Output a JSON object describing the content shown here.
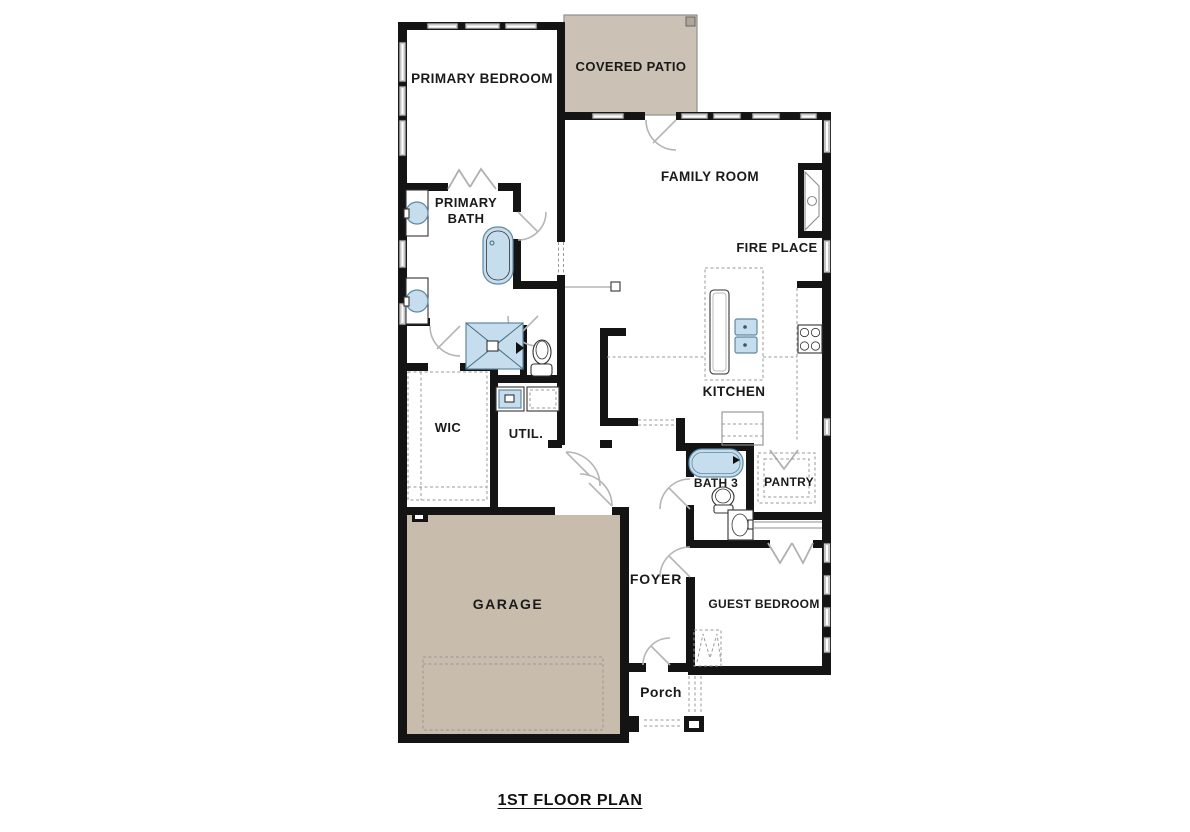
{
  "title": "1ST FLOOR PLAN",
  "rooms": {
    "primary_bedroom": "PRIMARY BEDROOM",
    "covered_patio": "COVERED PATIO",
    "family_room": "FAMILY ROOM",
    "fire_place": "FIRE PLACE",
    "primary_bath_line1": "PRIMARY",
    "primary_bath_line2": "BATH",
    "kitchen": "KITCHEN",
    "wic": "WIC",
    "util": "UTIL.",
    "bath3": "BATH 3",
    "pantry": "PANTRY",
    "foyer": "FOYER",
    "guest_bedroom": "GUEST BEDROOM",
    "garage": "GARAGE",
    "porch": "Porch"
  },
  "colors": {
    "wall": "#141414",
    "patio_fill": "#cbc1b4",
    "garage_fill": "#c8bcad",
    "fixture_blue": "#c5dded",
    "fixture_stroke": "#5d89a4",
    "window_gray": "#c6c6c6",
    "dash_gray": "#999999",
    "text": "#1a1a1a"
  },
  "fixtures": [
    "vanity-sink",
    "vanity-sink",
    "freestanding-tub",
    "shower",
    "toilet",
    "washer",
    "dryer",
    "kitchen-island-sink",
    "stove",
    "bathtub",
    "toilet",
    "vanity-sink",
    "fireplace",
    "closet-rod",
    "porch-columns"
  ]
}
